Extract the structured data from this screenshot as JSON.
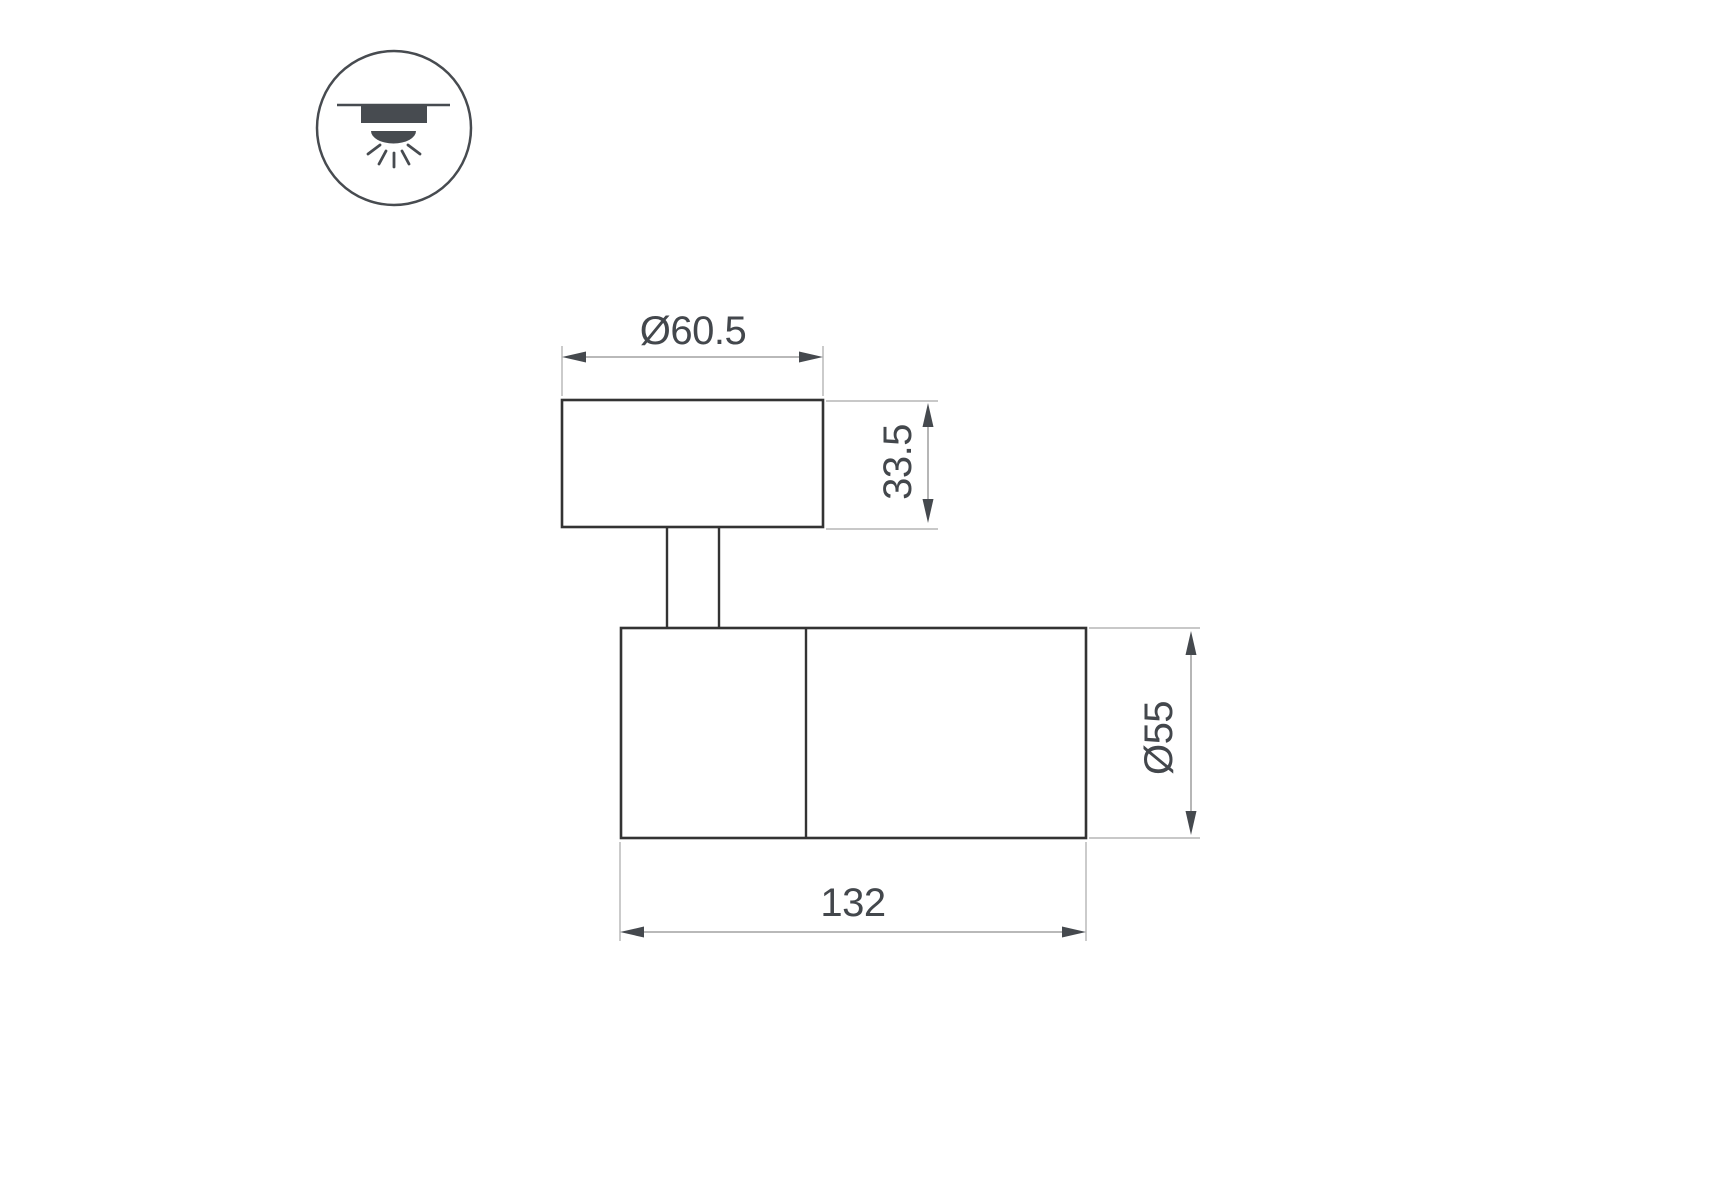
{
  "canvas": {
    "width_px": 1715,
    "height_px": 1200,
    "background": "#ffffff"
  },
  "icon_legend": {
    "name": "surface-ceiling-downlight-icon",
    "description": "circle badge containing a ceiling line, a mounted fixture block and a dome emitting five light rays downward",
    "color": "#474b50"
  },
  "drawing": {
    "subject": "adjustable surface spot luminaire, side elevation with dimensions",
    "outline_color": "#333333",
    "dimension_line_color": "#8f8f8f",
    "extension_line_color": "#a8a8a8",
    "arrow_color": "#45494e",
    "text_color": "#43474c",
    "dimensions": {
      "cap_diameter": {
        "label": "Ø60.5",
        "value": 60.5,
        "orientation": "horizontal",
        "location": "above mounting cap"
      },
      "cap_height": {
        "label": "33.5",
        "value": 33.5,
        "orientation": "vertical",
        "location": "right of mounting cap"
      },
      "body_diameter": {
        "label": "Ø55",
        "value": 55,
        "orientation": "vertical",
        "location": "right of lamp body"
      },
      "body_length": {
        "label": "132",
        "value": 132,
        "orientation": "horizontal",
        "location": "below lamp body"
      }
    }
  }
}
